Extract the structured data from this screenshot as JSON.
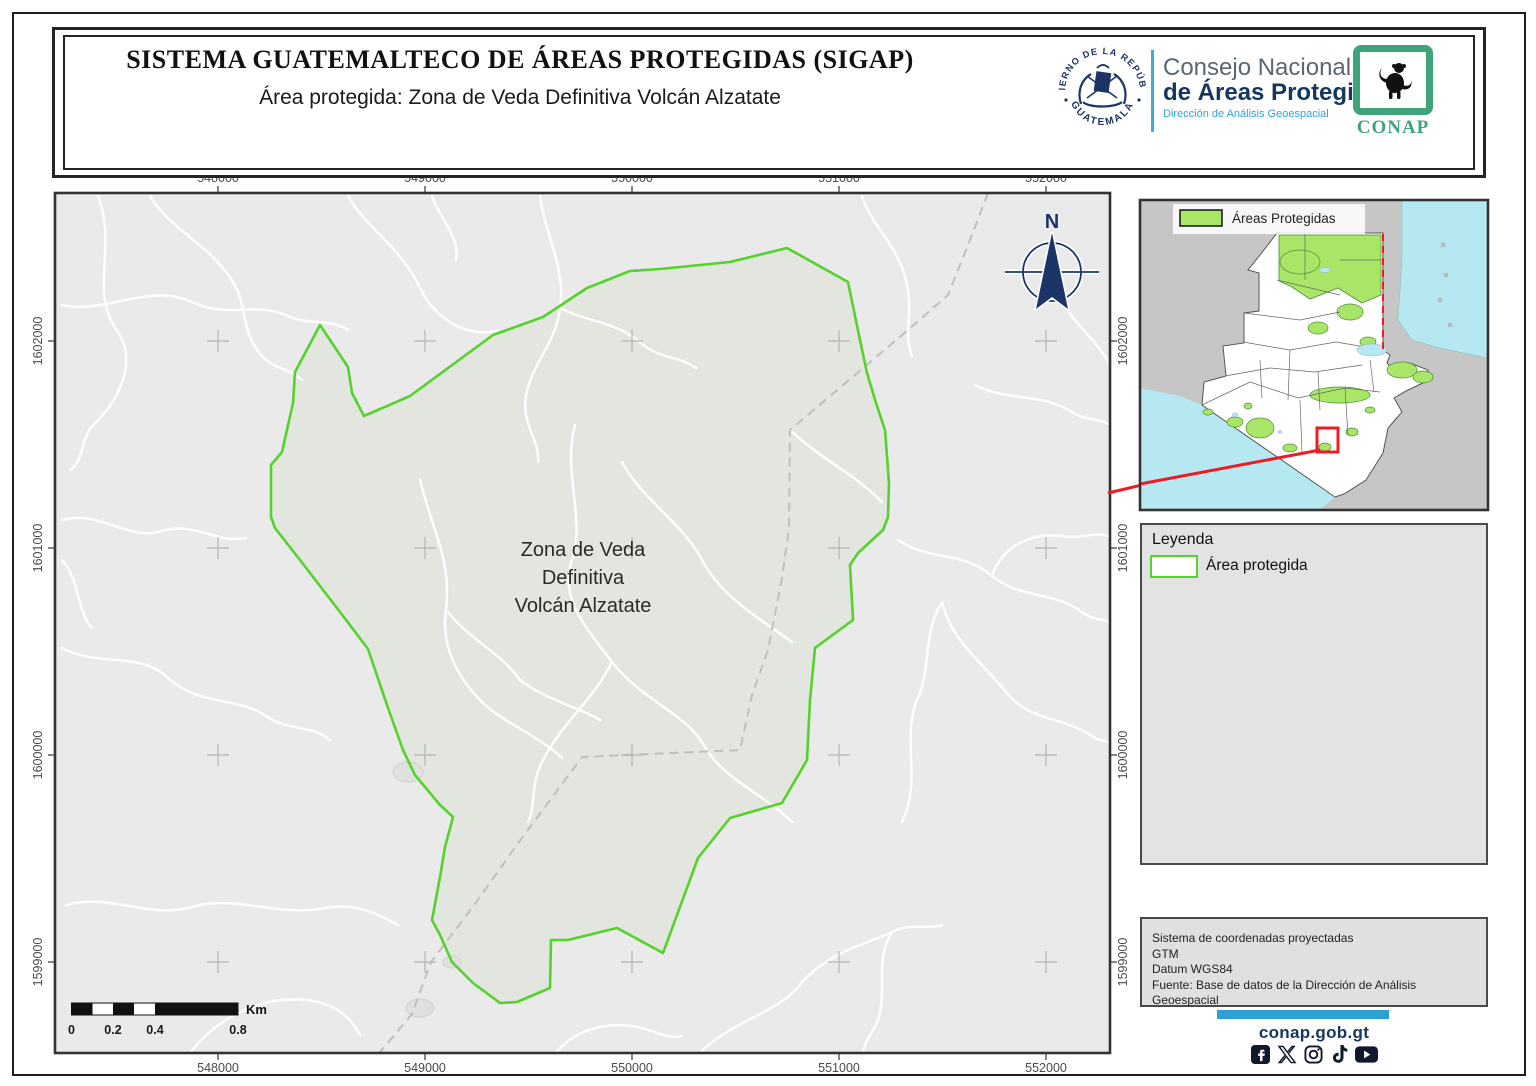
{
  "header": {
    "title": "SISTEMA GUATEMALTECO DE ÁREAS PROTEGIDAS  (SIGAP)",
    "subtitle": "Área protegida: Zona de Veda Definitiva Volcán Alzatate",
    "seal": {
      "top_text": "GOBIERNO DE LA REPÚBLICA",
      "bottom_text": "GUATEMALA"
    },
    "conap": {
      "line1": "Consejo Nacional",
      "line2": "de Áreas Protegidas",
      "line3": "Dirección de Análisis Geoespacial",
      "logo_text": "CONAP"
    }
  },
  "map": {
    "x_labels": [
      "548000",
      "549000",
      "550000",
      "551000",
      "552000"
    ],
    "y_labels": [
      "1602000",
      "1601000",
      "1600000",
      "1599000"
    ],
    "area_label_lines": [
      "Zona de Veda",
      "Definitiva",
      "Volcán Alzatate"
    ],
    "north_label": "N",
    "scalebar": {
      "labels": [
        "0",
        "0.2",
        "0.4",
        "0.8"
      ],
      "unit": "Km"
    }
  },
  "inset": {
    "legend_label": "Áreas Protegidas"
  },
  "legend": {
    "title": "Leyenda",
    "item_label": "Área protegida"
  },
  "credits": {
    "lines": [
      "Sistema de coordenadas proyectadas",
      "GTM",
      "Datum WGS84",
      "Fuente: Base de datos de la Dirección de Análisis Geoespacial"
    ]
  },
  "footer": {
    "website": "conap.gob.gt",
    "social_icons": [
      "facebook-icon",
      "x-icon",
      "instagram-icon",
      "tiktok-icon",
      "youtube-icon"
    ]
  },
  "colors": {
    "map_bg": "#eaeaea",
    "polygon_fill": "#e2e6df",
    "polygon_stroke": "#55d22c",
    "road": "#ffffff",
    "dashed_boundary": "#bfbfbf",
    "grid_cross": "#b5b5b5",
    "frame": "#333333",
    "axis_text": "#4a4a4a",
    "navy": "#1b3666",
    "light_blue": "#3ea9dc",
    "inset_land_gray": "#c6c6c6",
    "inset_water": "#b5e8f1",
    "inset_green": "#a9e667",
    "inset_green_edge": "#4a8f35",
    "red": "#ed1c24",
    "black": "#111111"
  },
  "geometry": {
    "frame": {
      "x": 55,
      "y": 193,
      "w": 1055,
      "h": 860
    },
    "grid_x": [
      218,
      425,
      632,
      839,
      1046
    ],
    "grid_y": [
      341,
      548,
      755,
      962
    ],
    "polygon": "787,248 848,282 860,340 867,373 876,403 885,430 889,483 888,517 883,530 858,553 850,565 853,620 815,648 810,700 807,760 782,803 730,818 698,858 663,953 617,928 568,940 551,940 550,988 517,1002 500,1003 473,983 457,967 452,962 440,935 432,920 440,877 445,847 453,817 440,805 415,775 403,750 388,708 368,649 340,612 300,560 275,528 271,517 271,465 282,452 293,403 295,372 320,325 348,367 352,393 364,416 410,396 493,335 543,317 587,288 630,271 660,269 730,262",
    "dashed_path": "M988,193 L970,240 L948,295 L908,330 L790,430 L789,528 L782,578 L768,650 L752,695 L740,750 L582,757 L519,842 L472,908 L431,962 L412,1014 L387,1044 L379,1053",
    "area_label_pos": {
      "x": 583,
      "y": 556,
      "dy": 28
    },
    "north_arrow": {
      "cx": 1052,
      "cy": 272,
      "r": 29
    },
    "scalebar": {
      "x": 71.5,
      "y": 1003,
      "h": 12,
      "ticks": [
        71.5,
        113,
        155,
        238
      ],
      "black": [
        [
          71.5,
          21
        ],
        [
          113,
          21
        ],
        [
          155,
          83
        ]
      ]
    },
    "roads": [
      "M62,305 C105,315 148,282 192,302 C232,320 252,300 288,316 C310,326 330,318 348,330",
      "M98,196 C118,248 88,292 118,332 C138,362 118,402 94,424 C80,438 85,460 70,470",
      "M150,196 C170,230 208,242 233,282 C248,306 240,332 262,356 C275,370 290,368 302,380",
      "M62,520 C100,510 128,540 158,532 C196,520 214,544 246,538",
      "M62,648 C100,668 138,650 168,678 C198,706 236,696 266,716 C290,732 310,724 330,740",
      "M66,905 C108,893 148,918 188,908 C236,893 276,918 326,908 C356,902 380,915 398,925",
      "M190,1053 C222,1012 272,992 318,1002 C340,1007 352,1020 360,1035",
      "M348,196 C366,228 402,248 420,288 C438,326 476,338 498,330",
      "M540,196 C546,238 566,268 560,308 C556,344 532,362 526,396 C521,424 540,440 538,462",
      "M560,308 C592,324 614,320 642,344 C662,360 680,356 696,368",
      "M575,425 C562,470 586,520 572,560 C558,600 590,632 612,662 C642,700 682,712 702,742 C722,780 762,792 792,822",
      "M612,662 C592,702 562,722 542,762 C530,786 536,806 528,822",
      "M862,196 C872,228 902,248 908,290 C912,316 904,336 912,356",
      "M700,1053 C732,1020 782,1012 802,982 C832,950 872,942 892,932 C912,922 928,930 942,925",
      "M892,932 C872,962 892,1002 872,1032 C862,1046 866,1050 862,1053",
      "M898,540 C930,562 962,550 992,576 C1022,600 1052,590 1082,612 C1096,622 1104,618 1108,622",
      "M942,602 C952,642 982,662 1006,692 C1030,722 1062,716 1092,736 C1100,742 1106,740 1108,742",
      "M942,602 C922,632 932,672 916,702 C902,742 922,782 902,822",
      "M992,576 C1002,546 1032,532 1062,536 C1080,539 1094,532 1108,536",
      "M1060,300 C1080,330 1098,342 1108,362",
      "M975,385 C1008,402 1040,392 1072,412 C1088,422 1100,418 1108,424",
      "M420,480 C432,530 452,560 446,610 C440,650 462,682 482,702 C502,722 542,738 562,758",
      "M622,462 C642,500 682,522 702,560 C722,598 762,620 792,642",
      "M790,430 C822,460 852,472 882,502",
      "M432,196 C440,220 460,236 456,260",
      "M556,1053 C572,1032 602,1022 632,1026 C652,1029 668,1040 682,1036",
      "M62,560 C80,580 76,610 92,628",
      "M448,612 C470,640 500,652 520,680 C546,700 576,706 600,720"
    ],
    "settlements": [
      [
        408,
        772,
        15,
        10
      ],
      [
        420,
        1008,
        14,
        9
      ],
      [
        452,
        962,
        9,
        6
      ]
    ],
    "red_leader": {
      "x1": 1108,
      "y1": 493,
      "x2": 1146,
      "y2": 484
    },
    "inset": {
      "x": 1140,
      "y": 200,
      "w": 348,
      "h": 310,
      "guatemala": "137,33 243,33 243,150 250,155 247,163 252,168 270,163 288,170 285,182 266,191 254,198 262,212 248,228 243,253 226,280 204,294 195,297 62,205 64,182 86,176 83,146 104,143 104,113 119,111 119,73 108,70 120,55",
      "caribbean": "262,0 348,0 348,158 300,148 272,140 258,120 262,60",
      "pacific": "0,188 40,196 62,205 196,296 180,310 0,310",
      "peten_green": "139,35 241,35 241,95 222,103 198,88 170,99 152,87 139,81",
      "green_blobs": [
        [
          210,
          112,
          13,
          8
        ],
        [
          178,
          128,
          10,
          6
        ],
        [
          228,
          142,
          8,
          5
        ],
        [
          262,
          170,
          15,
          8
        ],
        [
          283,
          177,
          10,
          6
        ],
        [
          200,
          195,
          30,
          8
        ],
        [
          120,
          228,
          14,
          10
        ],
        [
          95,
          222,
          8,
          5
        ],
        [
          150,
          248,
          7,
          4
        ],
        [
          185,
          247,
          6,
          4
        ],
        [
          212,
          232,
          6,
          4
        ],
        [
          230,
          210,
          5,
          3
        ],
        [
          68,
          212,
          5,
          3
        ],
        [
          108,
          206,
          4,
          3
        ],
        [
          160,
          62,
          20,
          12
        ]
      ],
      "dept_lines": [
        "M62,205 L110,182 L158,198 L205,188 L240,192",
        "M85,176 L130,168 L175,172 L222,165",
        "M103,142 L150,150 L196,142 L243,150",
        "M120,160 L122,198",
        "M150,150 L148,200",
        "M178,172 L180,210",
        "M205,188 L208,235",
        "M160,200 L162,252",
        "M230,160 L234,192",
        "M165,34 L165,80",
        "M200,60 L241,60",
        "M137,80 L200,95",
        "M104,113 L160,120 L200,112"
      ],
      "belize_border": "M243,34 L243,151",
      "red_rect": [
        177,
        228,
        21,
        24
      ],
      "red_line": "M180,250 L0,284",
      "islands": [
        [
          303,
          45
        ],
        [
          306,
          75
        ],
        [
          300,
          100
        ],
        [
          310,
          125
        ]
      ],
      "lakes": [
        [
          232,
          150,
          15,
          6
        ],
        [
          95,
          215,
          3,
          2
        ],
        [
          140,
          232,
          2,
          1.5
        ],
        [
          185,
          70,
          6,
          2.5
        ]
      ],
      "chip": {
        "x": 33,
        "y": 4,
        "w": 192,
        "h": 30,
        "sw_x": 40,
        "sw_y": 10,
        "sw_w": 42,
        "sw_h": 16,
        "tx": 92,
        "ty": 23
      }
    }
  }
}
